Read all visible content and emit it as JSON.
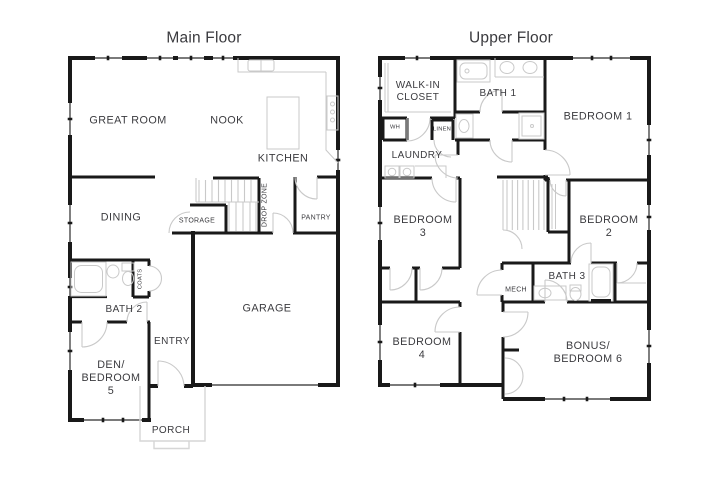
{
  "colors": {
    "background": "#ffffff",
    "wall": "#191919",
    "label_text": "#3b3b3f",
    "fixture_line": "#c9c9c9",
    "porch_line": "#d6d6d6"
  },
  "main_floor": {
    "title": "Main Floor",
    "labels": {
      "great_room": "GREAT ROOM",
      "nook": "NOOK",
      "kitchen": "KITCHEN",
      "dining": "DINING",
      "storage": "STORAGE",
      "drop_zone": "DROP ZONE",
      "pantry": "PANTRY",
      "coats": "COATS",
      "bath_2": "BATH 2",
      "den_bedroom_5": "DEN/\nBEDROOM\n5",
      "entry": "ENTRY",
      "garage": "GARAGE",
      "porch": "PORCH"
    }
  },
  "upper_floor": {
    "title": "Upper Floor",
    "labels": {
      "walk_in_closet": "WALK-IN\nCLOSET",
      "bath_1": "BATH 1",
      "bedroom_1": "BEDROOM 1",
      "wh": "WH",
      "linen": "LINEN",
      "laundry": "LAUNDRY",
      "bedroom_3": "BEDROOM\n3",
      "bedroom_2": "BEDROOM\n2",
      "mech": "MECH",
      "bath_3": "BATH 3",
      "bedroom_4": "BEDROOM\n4",
      "bonus_bedroom_6": "BONUS/\nBEDROOM 6"
    }
  }
}
